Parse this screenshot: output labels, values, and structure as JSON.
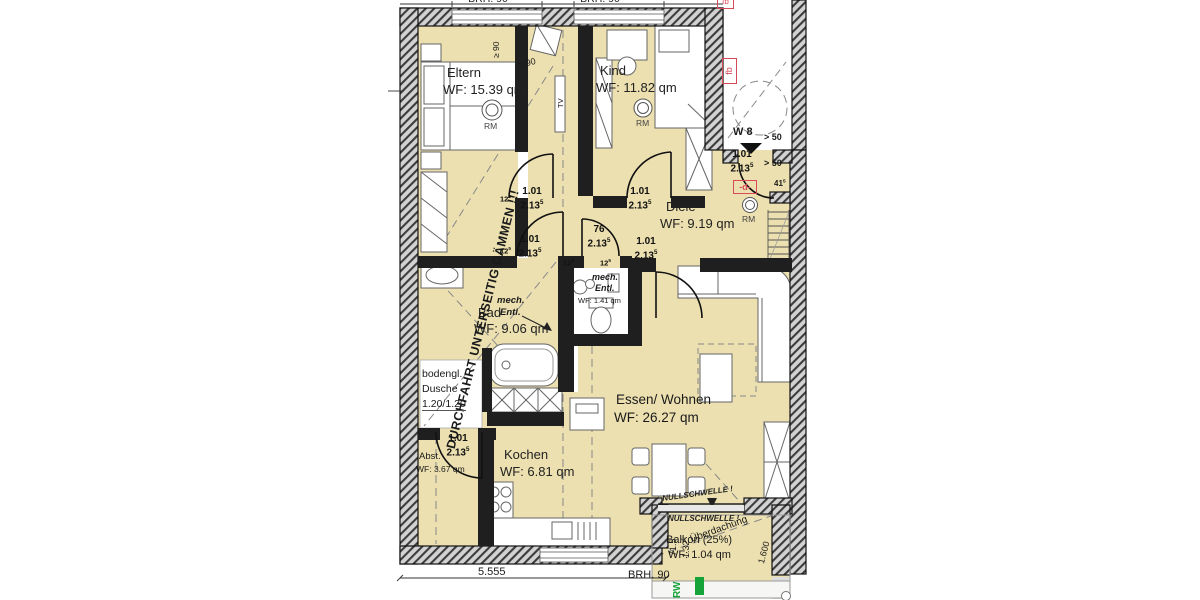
{
  "rooms": [
    {
      "name": "Eltern",
      "area": "WF: 15.39 qm"
    },
    {
      "name": "Kind",
      "area": "WF: 11.82 qm"
    },
    {
      "name": "Diele",
      "area": "WF: 9.19 qm"
    },
    {
      "name": "Bad",
      "area": "WF: 9.06 qm"
    },
    {
      "name": "Essen/ Wohnen",
      "area": "WF: 26.27 qm"
    },
    {
      "name": "Kochen",
      "area": "WF: 6.81 qm"
    },
    {
      "name": "Abst.",
      "area": "WF: 3.67 qm"
    },
    {
      "name": "Balkon (25%)",
      "area": "WF: 1.04 qm"
    }
  ],
  "wc": {
    "l1": "mech.",
    "l2": "Entl.",
    "area": "WF: 1.41 qm"
  },
  "bad_vent": {
    "l1": "mech.",
    "l2": "Entl."
  },
  "shower": {
    "l1": "bodengl.",
    "l2": "Dusche",
    "l3": "1.20/1.20"
  },
  "warning": "DURCHFAHRT UNTERSEITIG DÄMMEN !!!",
  "door": {
    "w": "1.01",
    "h": "2.13",
    "sup": "5",
    "wc_w": "76",
    "wall": "12",
    "wall_sup": "5"
  },
  "entrance": {
    "unit": "W 8",
    "clearance": "> 50",
    "tag_d": "-d-",
    "tag_fb": "fb",
    "dim": "41",
    "dim_sup": "5",
    "rm": "RM"
  },
  "annotations": {
    "rm": "RM",
    "tv": "TV",
    "min90": "≥ 90",
    "gt90": "> 90",
    "brh": "BRH. 90",
    "total_width": "5.555",
    "rw": "RW"
  },
  "balcony": {
    "null_threshold": "NULLSCHWELLE !",
    "roof": "Überdachung",
    "d1": "71.5",
    "d2": "1.32",
    "d2_sup": "5",
    "d3": "1.600"
  }
}
